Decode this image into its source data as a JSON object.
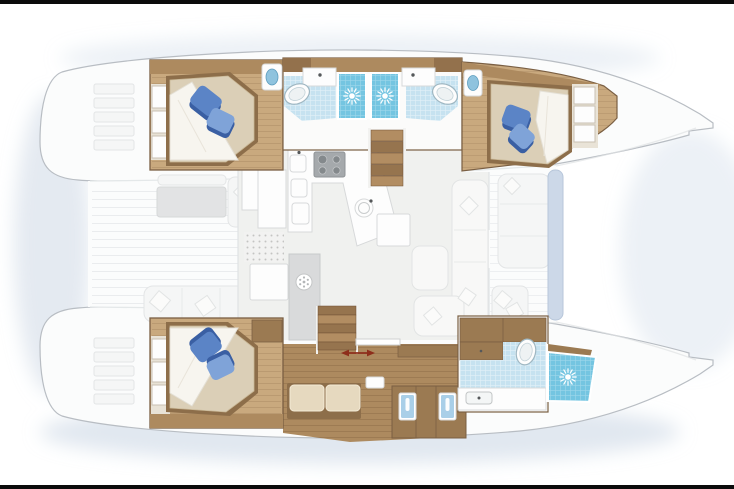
{
  "image": {
    "type": "yacht-floor-plan",
    "subject": "catamaran interior layout, top-down cutaway view",
    "bow_direction": "right",
    "stern_direction": "left",
    "frame": "thin black strips along top and bottom edges"
  },
  "colors": {
    "black-bar": "#0b0b0b",
    "hull-fill": "#fbfcfc",
    "hull-stroke": "#b8bdc3",
    "deck-line": "#e4e7ea",
    "shadow": "#c9d6e4",
    "salon-floor": "#f0f1ef",
    "fixture-white": "#fdfdfd",
    "counter-stroke": "#d7d9da",
    "wood-light": "#c9a97e",
    "wood-mid": "#ad8a5f",
    "wood-cabinet": "#9b7a52",
    "wood-trim": "#7a5f43",
    "wood-dark": "#8d6e4a",
    "mattress": "#dbcfb7",
    "sheet": "#f7f5ef",
    "cushion": "#e6d9bf",
    "pillow": "#5b84c6",
    "pillow-dark": "#3a5fa3",
    "pillow-light": "#7fa3d8",
    "tile": "#c6e2f0",
    "shower": "#74c5e1",
    "basin-blue": "#8fc3de",
    "toilet-stroke": "#9fb7c2",
    "appliance": "#a5a9ac",
    "burner": "#84898c",
    "fridge": "#d9dadb",
    "icon-gray": "#b3b6b8",
    "arrow-red": "#8e2e1b",
    "beam-blue": "#ccd8e8",
    "washed-fill": "#f5f6f6",
    "washed-stroke": "#e3e5e6",
    "washed-table": "#e2e3e4"
  },
  "vessel": {
    "upper_hull": {
      "rooms": [
        {
          "name": "aft-guest-cabin",
          "fixtures": [
            "double-berth",
            "two-blue-pillows",
            "wardrobe-lockers",
            "blue-washbasin"
          ]
        },
        {
          "name": "aft-bathroom",
          "fixtures": [
            "toilet",
            "washbasin-counter",
            "shower-stall"
          ]
        },
        {
          "name": "forward-bathroom",
          "fixtures": [
            "toilet",
            "washbasin-counter",
            "shower-stall"
          ]
        },
        {
          "name": "forward-guest-cabin",
          "fixtures": [
            "double-berth",
            "two-blue-pillows",
            "wardrobe-lockers",
            "blue-washbasin"
          ]
        },
        {
          "name": "companionway-stairs",
          "fixtures": [
            "five-wood-treads"
          ]
        }
      ]
    },
    "lower_hull": {
      "rooms": [
        {
          "name": "aft-owner-cabin",
          "fixtures": [
            "double-berth",
            "two-blue-pillows",
            "wardrobe-lockers",
            "vanity-unit"
          ]
        },
        {
          "name": "owner-passage",
          "fixtures": [
            "sofa-bench",
            "storage-cabinets",
            "two-glass-front-lockers",
            "side-table"
          ]
        },
        {
          "name": "forward-owner-bathroom",
          "fixtures": [
            "toilet",
            "washbasin-counter",
            "separate-shower-stall",
            "storage-drawers"
          ]
        },
        {
          "name": "companionway-stairs",
          "fixtures": [
            "five-wood-treads",
            "sliding-door",
            "red-travel-arrow"
          ]
        }
      ]
    },
    "salon": {
      "galley": [
        "four-burner-hob",
        "twin-square-sinks",
        "dishwasher",
        "round-sink",
        "refrigerator-column"
      ],
      "furniture": [
        "chart-table",
        "storage-units",
        "dinette-table",
        "l-shaped-settee",
        "white-throw-pillows",
        "textured-floor-mat"
      ]
    },
    "exterior": {
      "aft_cockpit": [
        "cockpit-table",
        "bench-seating",
        "chaise",
        "white-lounge-pillows"
      ],
      "forward_cockpit": [
        "bench-seating",
        "white-lounge-pillows",
        "blue-crossbeam-pad"
      ],
      "transoms": [
        "port-swim-steps",
        "starboard-swim-steps"
      ],
      "foredeck": [
        "twin-bows"
      ]
    }
  },
  "icons": [
    {
      "name": "sun-shower-icon",
      "meaning": "shower head",
      "count": 3
    },
    {
      "name": "snowflake-fridge-icon",
      "meaning": "refrigerator",
      "count": 1
    },
    {
      "name": "double-arrow-icon",
      "meaning": "sliding-door travel direction",
      "count": 1
    }
  ]
}
